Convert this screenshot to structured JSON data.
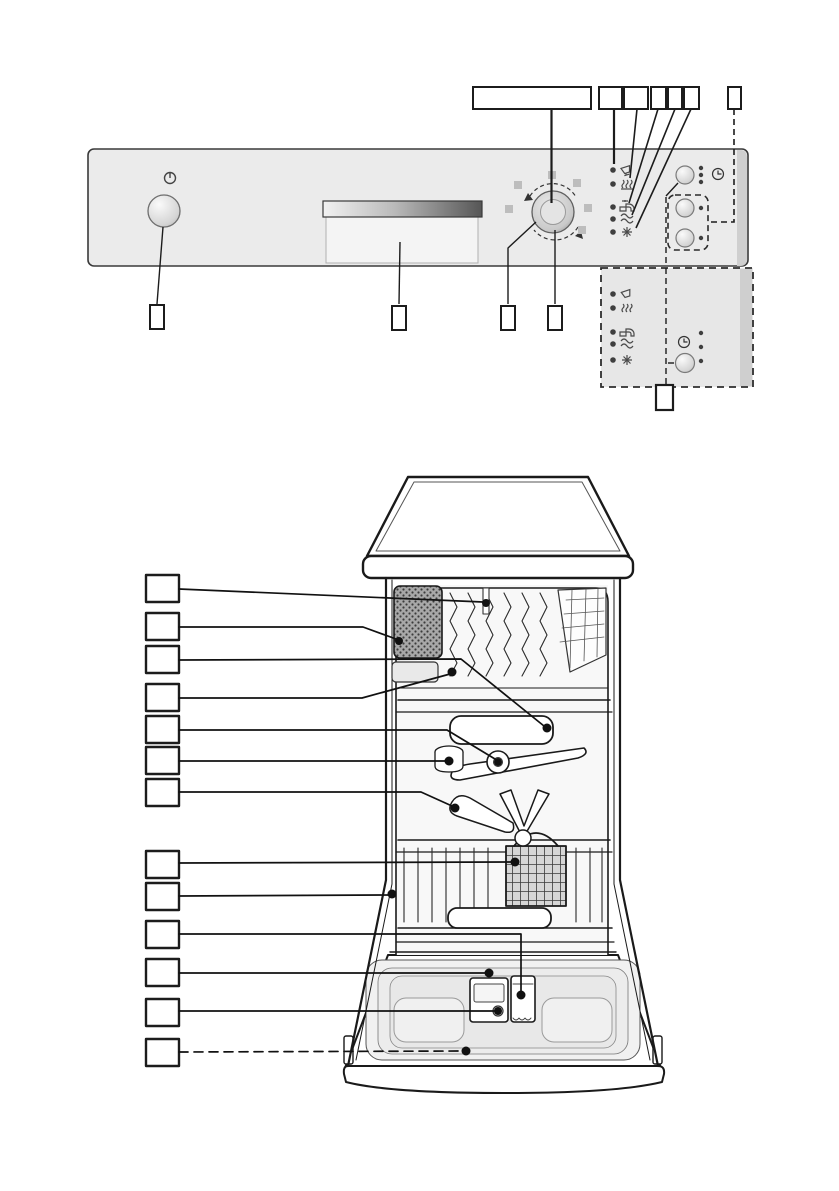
{
  "document": {
    "background": "#ffffff",
    "description": "Dishwasher overview diagram: control panel (top) and interior cutaway (bottom) with empty numbering callout boxes"
  },
  "colors": {
    "panel_fill": "#ebebeb",
    "panel_border": "#3a3a3a",
    "inset_panel_fill": "#e7e7e7",
    "line": "#1a1a1a",
    "led_dot": "#3f3f3f",
    "position_square": "#bdbdbd",
    "handle_dark": "#565656"
  },
  "control_panel": {
    "power_button": {
      "symbol_icon": "power-icon",
      "callout_label": ""
    },
    "door_handle": {
      "callout_label": ""
    },
    "program_selector": {
      "programs_callout_label": "",
      "ring_callout_label": "",
      "center_callout_label": "",
      "position_square_count": 6
    },
    "indicator_leds": [
      {
        "icon": "glass-icon",
        "callout_label": ""
      },
      {
        "icon": "steam-dish-icon",
        "callout_label": ""
      },
      {
        "icon": "water-tap-icon",
        "callout_label": ""
      },
      {
        "icon": "salt-refill-icon",
        "callout_label": ""
      },
      {
        "icon": "rinse-aid-star-icon",
        "callout_label": ""
      }
    ],
    "clock_icon": "clock-icon",
    "button_count": 3,
    "time_led_dots": 3,
    "options_callout_label": ""
  },
  "inset_panel_variant": {
    "indicator_icons": [
      "glass-icon",
      "steam-dish-icon",
      "water-tap-icon",
      "salt-refill-icon",
      "rinse-aid-star-icon"
    ],
    "clock_icon": "clock-icon",
    "button_count": 1,
    "led_dots": 3,
    "callout_label": ""
  },
  "interior_diagram": {
    "callouts": [
      {
        "label": "",
        "leader": "solid"
      },
      {
        "label": "",
        "leader": "solid"
      },
      {
        "label": "",
        "leader": "solid"
      },
      {
        "label": "",
        "leader": "solid"
      },
      {
        "label": "",
        "leader": "solid"
      },
      {
        "label": "",
        "leader": "solid"
      },
      {
        "label": "",
        "leader": "solid"
      },
      {
        "label": "",
        "leader": "solid"
      },
      {
        "label": "",
        "leader": "solid"
      },
      {
        "label": "",
        "leader": "solid"
      },
      {
        "label": "",
        "leader": "solid"
      },
      {
        "label": "",
        "leader": "solid"
      },
      {
        "label": "",
        "leader": "dashed"
      }
    ]
  }
}
